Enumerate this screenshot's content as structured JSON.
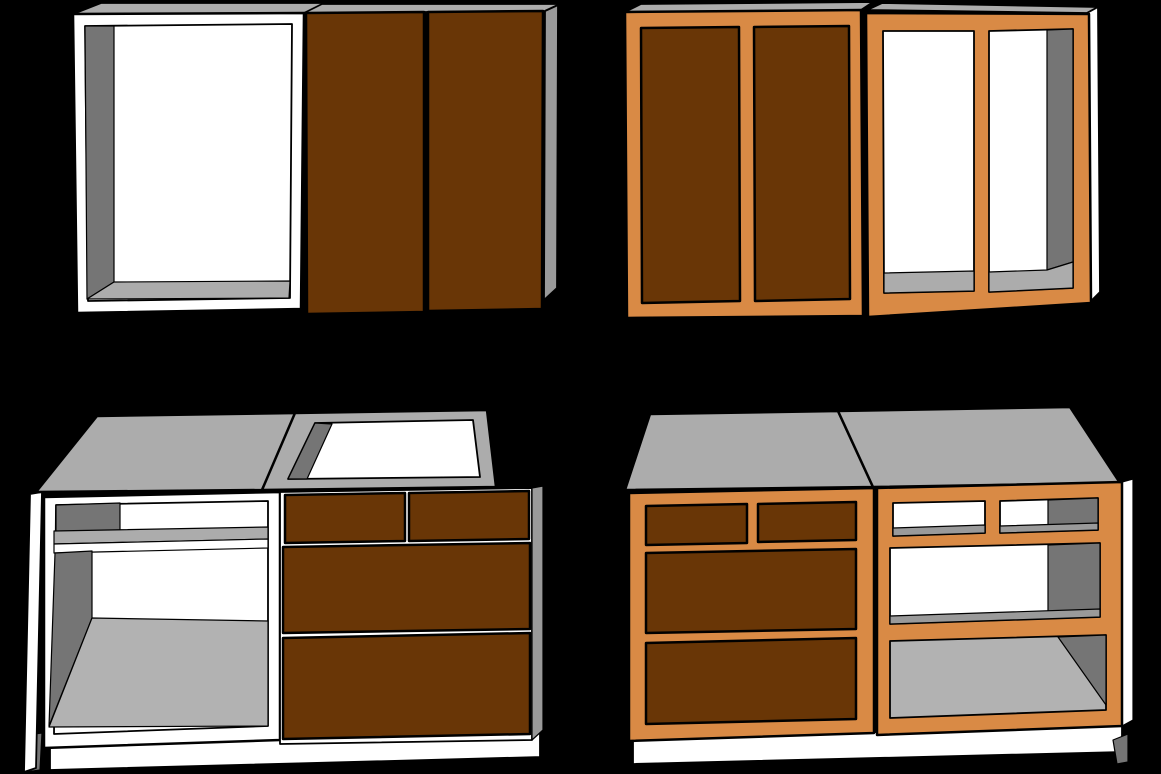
{
  "scene": {
    "title": "Cabinet construction comparison illustration",
    "background": "#000000",
    "outline": "#000000",
    "groups": [
      {
        "id": "wall-frameless",
        "position": "top-left",
        "description": "frameless wall cabinet pair: open carcass + double brown doors"
      },
      {
        "id": "wall-faceframe",
        "position": "top-right",
        "description": "face-frame wall cabinet pair: brown panel doors + open orange frame"
      },
      {
        "id": "base-frameless",
        "position": "bottom-left",
        "description": "frameless base pair: open carcass with shelf + brown drawer bank with open sink top"
      },
      {
        "id": "base-faceframe",
        "position": "bottom-right",
        "description": "face-frame base pair: brown drawer bank + open orange frame with shelf"
      }
    ]
  },
  "colors": {
    "carcass_white": "#ffffff",
    "top_gray": "#acacac",
    "side_gray": "#9a9a9a",
    "interior_dark_gray": "#757575",
    "floor_gray": "#b2b2b2",
    "door_brown": "#693606",
    "frame_orange": "#d98a45",
    "background_black": "#000000"
  }
}
